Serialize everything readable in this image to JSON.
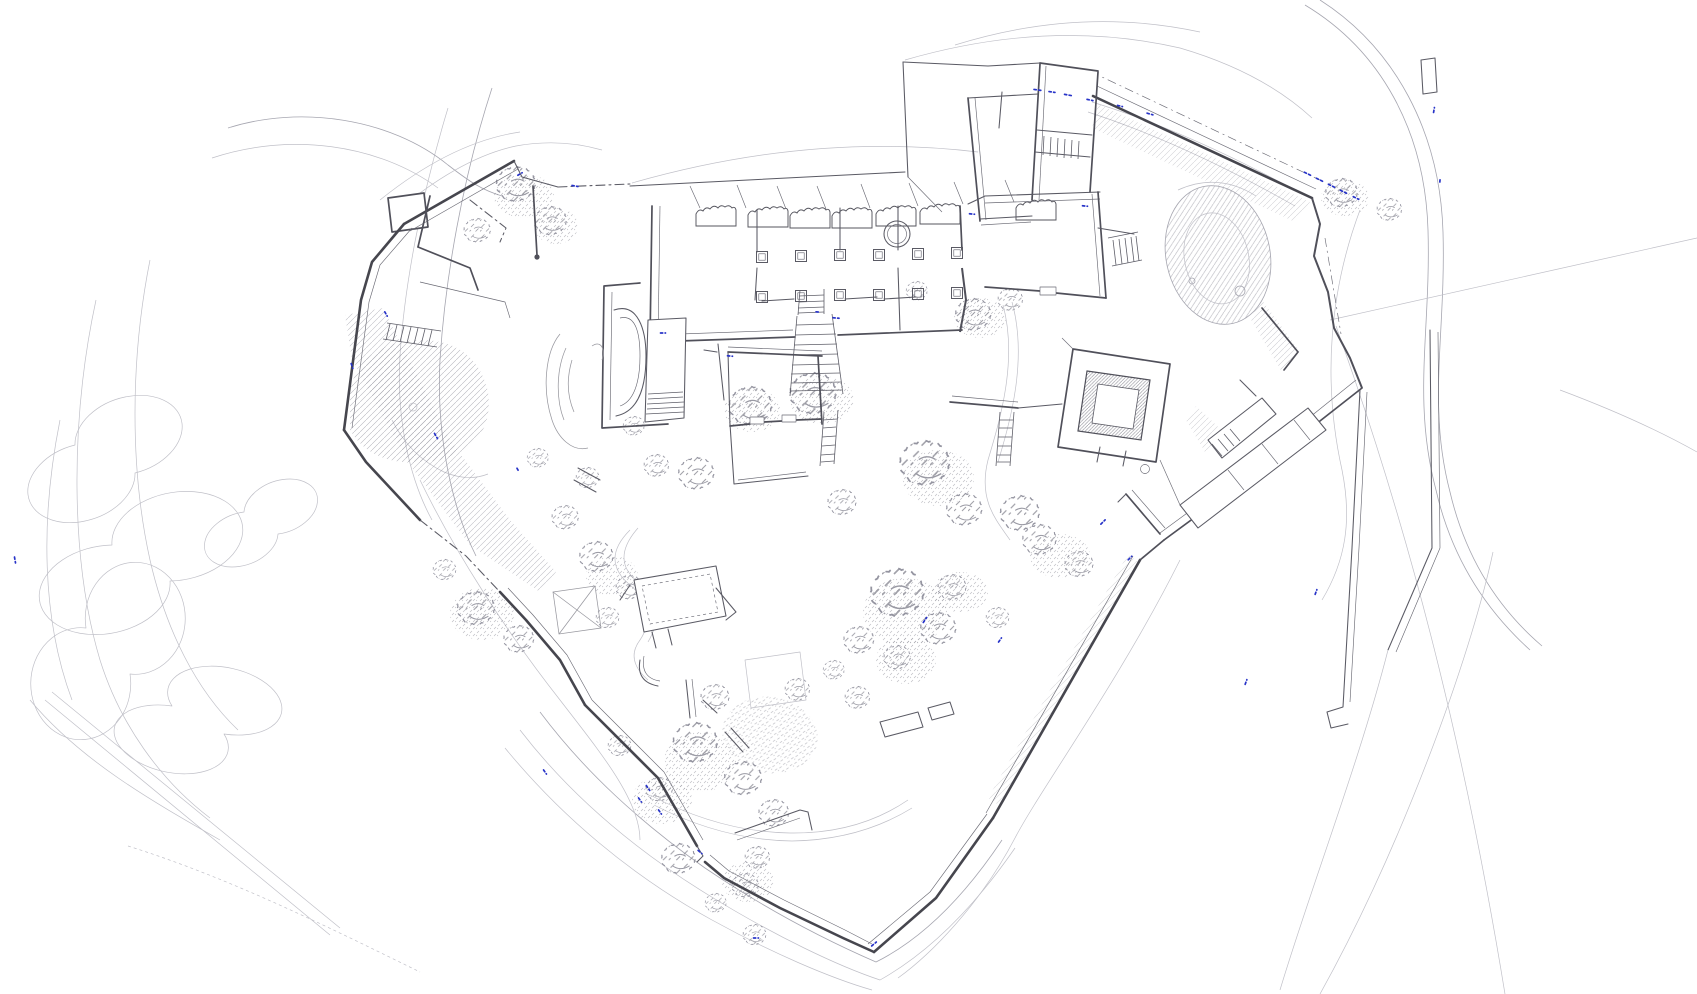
{
  "document": {
    "kind": "castle-site-plan",
    "canvas": {
      "width": 1697,
      "height": 994
    }
  },
  "palette": {
    "background": "#ffffff",
    "wall": "#46464e",
    "wall_ruin": "#50505a",
    "wall_light": "#5a5a64",
    "contour": "#a6a6b0",
    "contour_faint": "#c0c0c8",
    "hatch": "#8f8f99",
    "vegetation": "#8a8a94",
    "accent_blue": "#2733c8"
  },
  "features": {
    "perimeter_wall": {
      "label": "perimeter fortification wall"
    },
    "great_hall": {
      "label": "great hall with column rows and ruined north wall"
    },
    "west_rooms": {
      "label": "western rooms with apse and stairs"
    },
    "northeast_wing": {
      "label": "north-east wing buildings"
    },
    "east_range": {
      "label": "east range rooms and stairs"
    },
    "keep_tower": {
      "label": "square keep tower with inner court"
    },
    "east_buildings": {
      "label": "south-east buildings along rampart"
    },
    "south_ruins": {
      "label": "southern courtyard ruins and foundations"
    },
    "mound": {
      "label": "hatched earth mound"
    },
    "terrain": {
      "label": "terrain contour lines"
    },
    "slopes": {
      "label": "hatched slope banks"
    },
    "vegetation": {
      "label": "tree and shrub clusters"
    },
    "tracks": {
      "label": "paths and access road"
    },
    "outer_walls": {
      "label": "outer boundary walls south-east"
    },
    "accents": {
      "label": "blue survey accent marks"
    }
  },
  "trees": [
    [
      520,
      188,
      2.2
    ],
    [
      554,
      224,
      1.8
    ],
    [
      480,
      233,
      1.5
    ],
    [
      755,
      410,
      2.4
    ],
    [
      818,
      398,
      2.6
    ],
    [
      700,
      477,
      2.0
    ],
    [
      659,
      468,
      1.4
    ],
    [
      636,
      428,
      1.2
    ],
    [
      930,
      468,
      2.8
    ],
    [
      968,
      513,
      2.0
    ],
    [
      1024,
      517,
      2.2
    ],
    [
      845,
      505,
      1.6
    ],
    [
      903,
      598,
      3.0
    ],
    [
      942,
      632,
      2.0
    ],
    [
      862,
      643,
      1.7
    ],
    [
      1043,
      543,
      1.9
    ],
    [
      1082,
      567,
      1.6
    ],
    [
      600,
      560,
      1.9
    ],
    [
      632,
      590,
      1.5
    ],
    [
      480,
      612,
      2.1
    ],
    [
      522,
      642,
      1.7
    ],
    [
      447,
      572,
      1.3
    ],
    [
      700,
      747,
      2.5
    ],
    [
      747,
      782,
      2.1
    ],
    [
      777,
      816,
      1.7
    ],
    [
      662,
      792,
      1.5
    ],
    [
      622,
      748,
      1.3
    ],
    [
      682,
      862,
      1.9
    ],
    [
      748,
      888,
      1.5
    ],
    [
      800,
      692,
      1.4
    ],
    [
      836,
      672,
      1.2
    ],
    [
      757,
      937,
      1.3
    ],
    [
      977,
      318,
      2.0
    ],
    [
      1013,
      302,
      1.4
    ],
    [
      919,
      293,
      1.2
    ],
    [
      1345,
      196,
      1.8
    ],
    [
      1392,
      212,
      1.4
    ],
    [
      568,
      520,
      1.5
    ],
    [
      610,
      620,
      1.3
    ],
    [
      718,
      700,
      1.6
    ],
    [
      860,
      700,
      1.4
    ],
    [
      900,
      660,
      1.5
    ],
    [
      955,
      590,
      1.6
    ],
    [
      1000,
      620,
      1.3
    ],
    [
      540,
      460,
      1.2
    ],
    [
      590,
      480,
      1.3
    ],
    [
      760,
      860,
      1.4
    ],
    [
      718,
      905,
      1.2
    ]
  ],
  "accent_marks": [
    [
      1038,
      90,
      8,
      8
    ],
    [
      1052,
      92,
      6,
      8
    ],
    [
      1068,
      95,
      7,
      10
    ],
    [
      1090,
      100,
      6,
      12
    ],
    [
      1120,
      106,
      5,
      14
    ],
    [
      1150,
      114,
      6,
      16
    ],
    [
      1308,
      174,
      8,
      26
    ],
    [
      1320,
      180,
      8,
      26
    ],
    [
      1332,
      186,
      8,
      26
    ],
    [
      1344,
      192,
      8,
      26
    ],
    [
      1356,
      198,
      6,
      26
    ],
    [
      575,
      186,
      6,
      10
    ],
    [
      520,
      174,
      5,
      -30
    ],
    [
      436,
      436,
      6,
      60
    ],
    [
      386,
      314,
      5,
      60
    ],
    [
      352,
      366,
      5,
      70
    ],
    [
      648,
      788,
      6,
      55
    ],
    [
      640,
      800,
      5,
      55
    ],
    [
      660,
      812,
      5,
      55
    ],
    [
      700,
      852,
      5,
      40
    ],
    [
      874,
      944,
      6,
      -40
    ],
    [
      925,
      620,
      6,
      -55
    ],
    [
      1000,
      640,
      5,
      -55
    ],
    [
      1103,
      522,
      6,
      -45
    ],
    [
      1130,
      558,
      5,
      -45
    ],
    [
      836,
      318,
      6,
      5
    ],
    [
      730,
      356,
      5,
      5
    ],
    [
      972,
      214,
      5,
      5
    ],
    [
      818,
      312,
      4,
      5
    ],
    [
      1085,
      206,
      5,
      5
    ],
    [
      15,
      560,
      6,
      80
    ],
    [
      545,
      772,
      5,
      55
    ],
    [
      756,
      938,
      5,
      0
    ],
    [
      1246,
      682,
      5,
      -70
    ],
    [
      1316,
      592,
      5,
      -70
    ],
    [
      663,
      333,
      5,
      0
    ],
    [
      518,
      470,
      4,
      60
    ],
    [
      1434,
      110,
      5,
      -80
    ],
    [
      1440,
      180,
      4,
      -85
    ]
  ]
}
